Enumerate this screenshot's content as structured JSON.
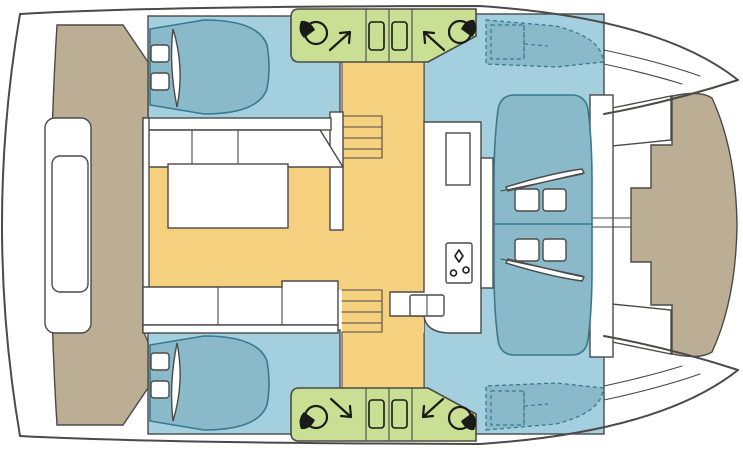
{
  "page": {
    "aria_label": "Catamaran interior layout floor plan, top view",
    "background": "#ffffff"
  },
  "palette": {
    "outline": "#4a4a48",
    "deck": "#ffffff",
    "cabin_floor": "#a4cfdf",
    "berth": "#8abaca",
    "berth_outline": "#39798f",
    "wet_area_green": "#c9df93",
    "saloon_floor": "#f5d07f",
    "exterior_deck_tan": "#bcae95",
    "icon_black": "#1a1a18"
  },
  "regions": [
    {
      "id": "hull-silhouette",
      "fill_key": "deck"
    },
    {
      "id": "cabin-top-left",
      "fill_key": "cabin_floor"
    },
    {
      "id": "cabin-bottom-left",
      "fill_key": "cabin_floor"
    },
    {
      "id": "cabin-right-section",
      "fill_key": "cabin_floor"
    },
    {
      "id": "forepeak-berth-top",
      "fill_key": "berth"
    },
    {
      "id": "forepeak-berth-bottom",
      "fill_key": "berth"
    },
    {
      "id": "saloon-and-corridor",
      "fill_key": "saloon_floor"
    },
    {
      "id": "wet-area-top",
      "fill_key": "wet_area_green"
    },
    {
      "id": "wet-area-bottom",
      "fill_key": "wet_area_green"
    },
    {
      "id": "aft-deck-left",
      "fill_key": "exterior_deck_tan"
    },
    {
      "id": "foredeck-right",
      "fill_key": "exterior_deck_tan"
    }
  ],
  "icons": {
    "toilet": [
      "toilet-icon-top-left",
      "toilet-icon-top-right",
      "toilet-icon-bottom-left",
      "toilet-icon-bottom-right"
    ],
    "arrows": [
      "arrow-up-right-icon",
      "arrow-up-left-icon",
      "arrow-down-right-icon",
      "arrow-down-left-icon"
    ],
    "deck_hatches": 4,
    "galley": [
      "stove-icon",
      "double-sink-icon"
    ]
  },
  "inventory": {
    "double_berths": 4,
    "pillows": 8,
    "staircases": 2,
    "stair_treads_each": 3,
    "saloon_furniture": [
      "corner-sofa",
      "bench-sofa",
      "rectangular-table"
    ],
    "galley_items": [
      "counter",
      "double-sink",
      "stove",
      "locker"
    ],
    "exterior_items": [
      "aft-bench",
      "foredeck-lockers"
    ]
  }
}
